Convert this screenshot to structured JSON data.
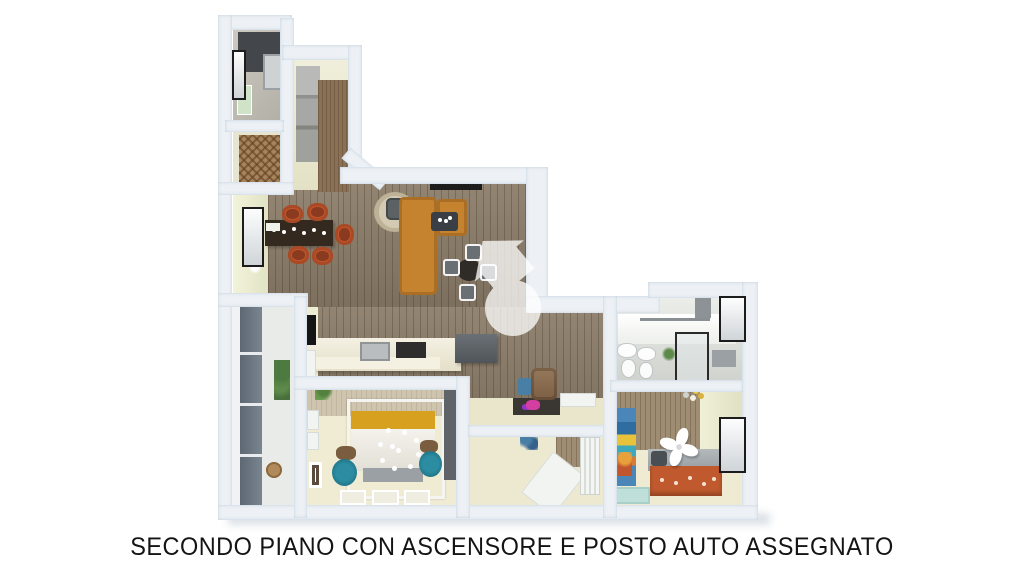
{
  "caption": {
    "text": "SECONDO PIANO CON ASCENSORE E POSTO AUTO ASSEGNATO"
  },
  "watermark": {
    "icon": "house-logo-watermark",
    "opacity": "0.75"
  },
  "icons": {
    "fan": "ceiling-fan-icon",
    "chandelier": "sparkle-chandelier-icon",
    "plant": "plant-icon"
  },
  "palette": {
    "wall": "#edf1f5",
    "wall_edge": "#d3dde6",
    "wood": "#8b7c68",
    "wood_dark": "#6e614f",
    "cream_floor": "#ebe8cd",
    "cream_wall": "#eceed2",
    "accent_beige": "#cfc4ad",
    "accent_wood_wall": "#9e8c73",
    "sofa_orange": "#c5832f",
    "chair_orange": "#c2542b",
    "chair_seat": "#8a3a1e",
    "table_dark": "#33291f",
    "mustard": "#d7a01f",
    "teal": "#20788c",
    "bed2_orange": "#c05a2e",
    "glass_door": "#65707b",
    "bath_floor": "#d6d8d4",
    "dark_gray": "#54595d",
    "black": "#1c1c1c",
    "white": "#ffffff",
    "caption_color": "#141414",
    "background": "#ffffff"
  }
}
